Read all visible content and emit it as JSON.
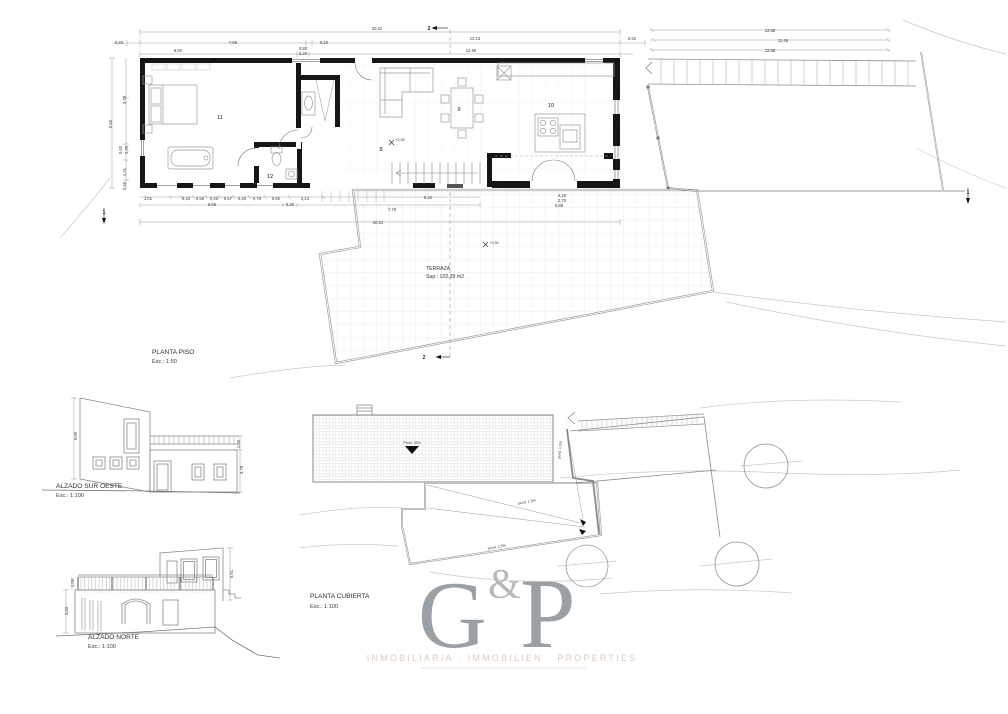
{
  "plans": {
    "planta_piso": {
      "label": "PLANTA PISO",
      "scale": "Esc.: 1:50"
    },
    "alzado_sur_oeste": {
      "label": "ALZADO SUR OESTE",
      "scale": "Esc.: 1:100"
    },
    "alzado_norte": {
      "label": "ALZADO NORTE",
      "scale": "Esc.: 1:100"
    },
    "planta_cubierta": {
      "label": "PLANTA CUBIERTA",
      "scale": "Esc.: 1:100"
    }
  },
  "terrace": {
    "name": "TERRAZA",
    "area": "Sup.: 102,39 m2"
  },
  "logo": {
    "g": "G",
    "amp": "&",
    "p": "P",
    "tagline": "INMOBILIARIA · IMMOBILIEN · PROPERTIES"
  },
  "colors": {
    "wall": "#161616",
    "line_medium": "#8a8a8a",
    "line_light": "#c9c9c9",
    "grid": "#d8d8d8",
    "logo_gray": "#9ba0a5",
    "tagline": "#ddccbe"
  },
  "annotations": [
    {
      "x": 377,
      "y": 30,
      "t": "20,21"
    },
    {
      "x": 119,
      "y": 44,
      "t": "0,33"
    },
    {
      "x": 233,
      "y": 44,
      "t": "7,65"
    },
    {
      "x": 324,
      "y": 44,
      "t": "0,10"
    },
    {
      "x": 475,
      "y": 40,
      "t": "12,13"
    },
    {
      "x": 632,
      "y": 40,
      "t": "0,92"
    },
    {
      "x": 178,
      "y": 52,
      "t": "6,92"
    },
    {
      "x": 303,
      "y": 50,
      "t": "0,80"
    },
    {
      "x": 303,
      "y": 55,
      "t": "2,20"
    },
    {
      "x": 471,
      "y": 52,
      "t": "12,59"
    },
    {
      "x": 770,
      "y": 32,
      "t": "12,58"
    },
    {
      "x": 783,
      "y": 42,
      "t": "11,46"
    },
    {
      "x": 770,
      "y": 52,
      "t": "12,58"
    },
    {
      "x": 126,
      "y": 100,
      "t": "3,79",
      "r": -90
    },
    {
      "x": 112,
      "y": 124,
      "t": "5,60",
      "r": -90
    },
    {
      "x": 122,
      "y": 150,
      "t": "0,60",
      "r": -90
    },
    {
      "x": 128,
      "y": 150,
      "t": "2,20",
      "r": -90
    },
    {
      "x": 126,
      "y": 172,
      "t": "1,21",
      "r": -90
    },
    {
      "x": 126,
      "y": 186,
      "t": "0,55",
      "r": -90
    },
    {
      "x": 148,
      "y": 200,
      "t": "1,01"
    },
    {
      "x": 186,
      "y": 200,
      "t": "0,43"
    },
    {
      "x": 200,
      "y": 200,
      "t": "0,58"
    },
    {
      "x": 214,
      "y": 200,
      "t": "0,40"
    },
    {
      "x": 228,
      "y": 200,
      "t": "0,57"
    },
    {
      "x": 242,
      "y": 200,
      "t": "0,40"
    },
    {
      "x": 257,
      "y": 200,
      "t": "0,79"
    },
    {
      "x": 276,
      "y": 200,
      "t": "0,82"
    },
    {
      "x": 305,
      "y": 200,
      "t": "4,13"
    },
    {
      "x": 428,
      "y": 199,
      "t": "6,42"
    },
    {
      "x": 212,
      "y": 206,
      "t": "6,55"
    },
    {
      "x": 290,
      "y": 206,
      "t": "0,20"
    },
    {
      "x": 392,
      "y": 211,
      "t": "7,78"
    },
    {
      "x": 378,
      "y": 224,
      "t": "20,21"
    },
    {
      "x": 562,
      "y": 197,
      "t": "4,18"
    },
    {
      "x": 562,
      "y": 202,
      "t": "2,70"
    },
    {
      "x": 559,
      "y": 207,
      "t": "5,88"
    },
    {
      "x": 220,
      "y": 119,
      "t": "11",
      "c": "room"
    },
    {
      "x": 270,
      "y": 178,
      "t": "12",
      "c": "room"
    },
    {
      "x": 381,
      "y": 151,
      "t": "8",
      "c": "room"
    },
    {
      "x": 459,
      "y": 111,
      "t": "9",
      "c": "room"
    },
    {
      "x": 551,
      "y": 107,
      "t": "10",
      "c": "room"
    },
    {
      "x": 400,
      "y": 141,
      "t": "+3,50",
      "c": "lvl"
    },
    {
      "x": 494,
      "y": 244,
      "t": "+3,50",
      "c": "lvl"
    },
    {
      "x": 429,
      "y": 30,
      "t": "2",
      "c": "sec"
    },
    {
      "x": 424,
      "y": 359,
      "t": "2",
      "c": "sec"
    },
    {
      "x": 968,
      "y": 194,
      "t": "1",
      "c": "sec"
    },
    {
      "x": 104,
      "y": 214,
      "t": "1",
      "c": "sec"
    },
    {
      "x": 77,
      "y": 436,
      "t": "6,00",
      "r": -90
    },
    {
      "x": 240,
      "y": 444,
      "t": "1,00",
      "r": -90
    },
    {
      "x": 243,
      "y": 470,
      "t": "3,78",
      "r": -90
    },
    {
      "x": 74,
      "y": 583,
      "t": "1,00",
      "r": -90
    },
    {
      "x": 68,
      "y": 611,
      "t": "3,83",
      "r": -90
    },
    {
      "x": 233,
      "y": 574,
      "t": "5,61",
      "r": -90
    },
    {
      "x": 412,
      "y": 444,
      "t": "Pend. 35%",
      "c": "tiny"
    },
    {
      "x": 527,
      "y": 503,
      "t": "pend. 1,5%",
      "c": "tiny",
      "r": -10
    },
    {
      "x": 497,
      "y": 548,
      "t": "pend. 1,5%",
      "c": "tiny",
      "r": -10
    },
    {
      "x": 561,
      "y": 450,
      "t": "pend. 1,5%",
      "c": "tiny",
      "r": -85
    }
  ]
}
